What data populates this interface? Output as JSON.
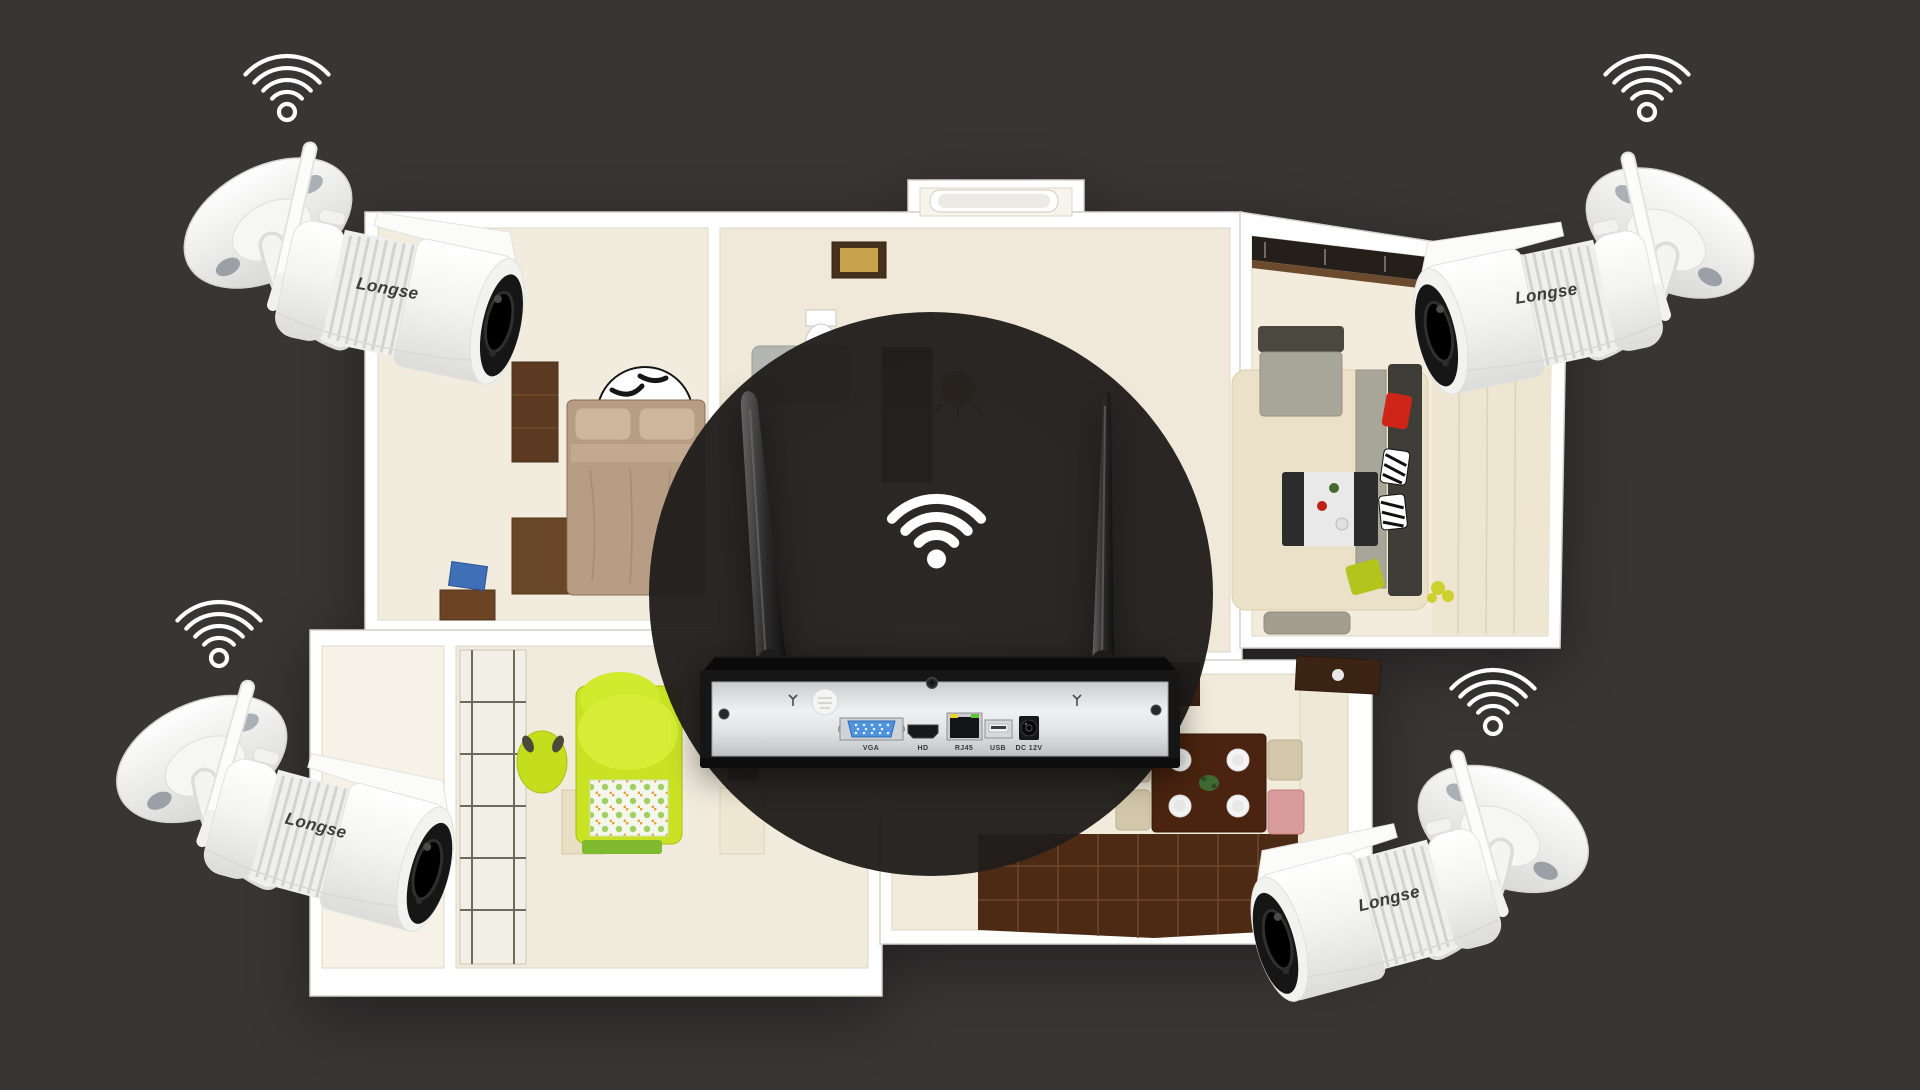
{
  "scene": {
    "title": "Wireless NVR kit with four WiFi cameras over a 3D house floor plan",
    "background_color": "#383535"
  },
  "brand": "Longse",
  "cameras": [
    {
      "position": "top-left",
      "label": "Longse"
    },
    {
      "position": "top-right",
      "label": "Longse"
    },
    {
      "position": "bottom-left",
      "label": "Longse"
    },
    {
      "position": "bottom-right",
      "label": "Longse"
    }
  ],
  "nvr": {
    "antenna_count": 2,
    "ports": [
      {
        "name": "vga",
        "label": "VGA"
      },
      {
        "name": "hdmi",
        "label": "HD"
      },
      {
        "name": "ethernet",
        "label": "RJ45"
      },
      {
        "name": "usb",
        "label": "USB"
      },
      {
        "name": "power",
        "label": "DC 12V"
      }
    ]
  },
  "icons": {
    "corner_wifi": "wifi-signal-icon",
    "hub_wifi": "wifi-hub-icon"
  },
  "colors": {
    "background": "#383535",
    "floor_cream": "#f2ecdf",
    "wall_white": "#ffffff",
    "vga_blue": "#4f93dd",
    "led_yellow": "#ead32f",
    "led_green": "#5ec433",
    "kids_bed_green": "#c9e224",
    "pillow_red": "#cf2418",
    "wood_dark": "#4d2a14"
  }
}
